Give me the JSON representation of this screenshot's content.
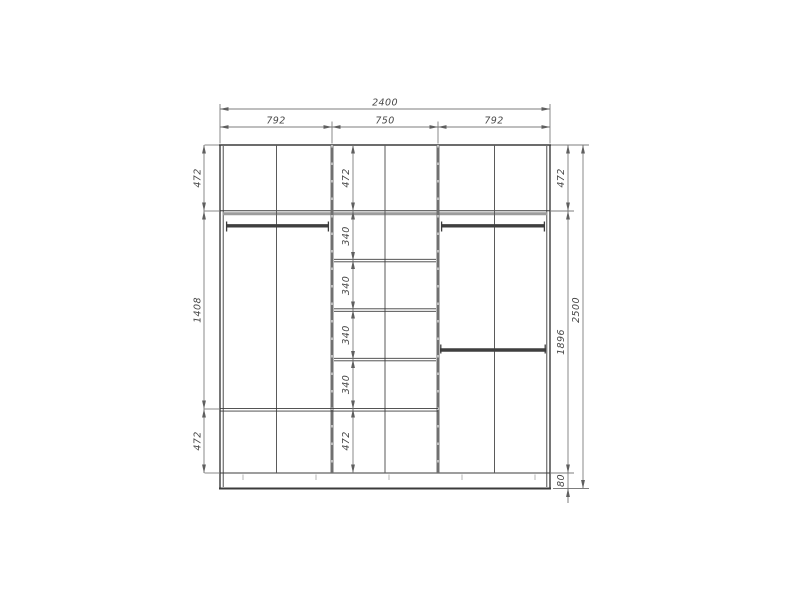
{
  "canvas": {
    "background": "#ffffff",
    "structure_line_color": "#3b3b3b",
    "shelf_gray_color": "#9c9c9c",
    "dimension_line_color": "#7d7d7d",
    "text_color": "#474747"
  },
  "dimensions": {
    "total_width": "2400",
    "section_widths": [
      "792",
      "750",
      "792"
    ],
    "left_column": [
      "472",
      "1408",
      "472"
    ],
    "center_column": [
      "472",
      "340",
      "340",
      "340",
      "340",
      "472"
    ],
    "right_column": [
      "472",
      "1896",
      "80"
    ],
    "total_height": "2500"
  }
}
